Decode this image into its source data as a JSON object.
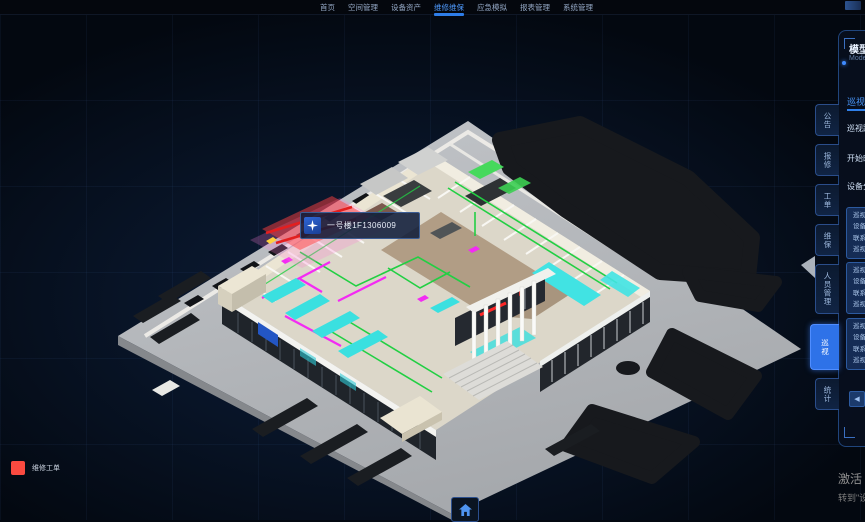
{
  "nav": {
    "items": [
      {
        "label": "首页"
      },
      {
        "label": "空间管理"
      },
      {
        "label": "设备资产"
      },
      {
        "label": "维修维保"
      },
      {
        "label": "应急模拟"
      },
      {
        "label": "报表管理"
      },
      {
        "label": "系统管理"
      }
    ],
    "active": "维修维保"
  },
  "scene": {
    "tooltip": {
      "text": "一号楼1F1306009"
    }
  },
  "legend": {
    "repair_order": {
      "label": "维修工单",
      "color": "#fa4a40"
    }
  },
  "side_tabs": {
    "items": [
      {
        "label": "公告"
      },
      {
        "label": "报修"
      },
      {
        "label": "工单"
      },
      {
        "label": "维保"
      },
      {
        "label": "人员管理"
      },
      {
        "label": "巡视"
      },
      {
        "label": "统计"
      }
    ],
    "active": "巡视"
  },
  "panel": {
    "title": "模型巡视",
    "subtitle": "Model Patrol",
    "tab": "巡视计划",
    "fields": [
      {
        "label": "巡视路线"
      },
      {
        "label": "开始时间"
      },
      {
        "label": "设备分类"
      }
    ],
    "cards": [
      {
        "lines": [
          "巡视点位",
          "设备名称",
          "联系电话",
          "巡视状态"
        ]
      },
      {
        "lines": [
          "巡视点位",
          "设备名称",
          "联系电话",
          "巡视状态"
        ]
      },
      {
        "lines": [
          "巡视点位",
          "设备名称",
          "联系电话",
          "巡视状态"
        ]
      }
    ],
    "prev_arrow": "◀"
  },
  "watermark": {
    "line1": "激活 Windows",
    "line2": "转到\"设置\"以激活 Windows。"
  },
  "colors": {
    "nav_active": "#4f9bff",
    "tab_active_bg": "#2e72e8",
    "pipe_green": "#22cf43",
    "pipe_magenta": "#f32bf3",
    "glass_cyan": "#3ae0e0",
    "alert_red": "#ff2727"
  }
}
